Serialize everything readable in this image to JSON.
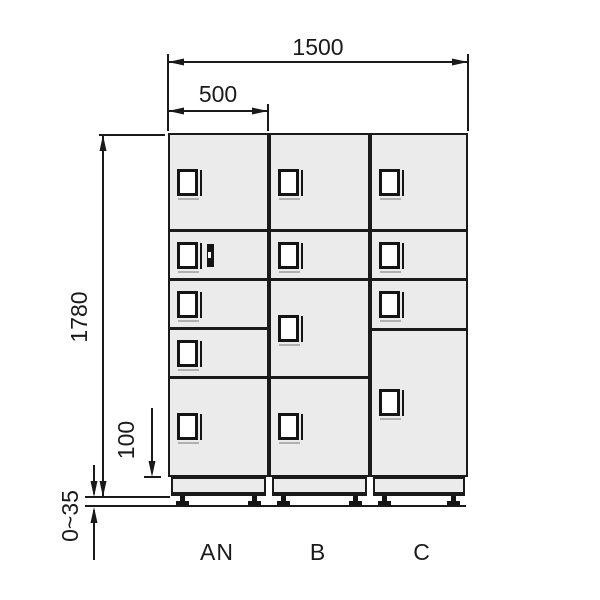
{
  "diagram": {
    "title": "locker-front-elevation",
    "dimension_labels": {
      "total_width": "1500",
      "column_width": "500",
      "total_height": "1780",
      "plinth_height": "100",
      "adjuster_range": "0~35"
    },
    "colors": {
      "line": "#1a1a1a",
      "door_fill": "#ebebeb",
      "handle_fill": "#ffffff",
      "background": "#ffffff"
    },
    "columns": [
      {
        "label": "AN",
        "compartments": [
          {
            "height_px": 97,
            "lock": false
          },
          {
            "height_px": 49,
            "lock": true
          },
          {
            "height_px": 49,
            "lock": false
          },
          {
            "height_px": 49,
            "lock": false
          },
          {
            "height_px": 95,
            "lock": false
          }
        ]
      },
      {
        "label": "B",
        "compartments": [
          {
            "height_px": 97,
            "lock": false
          },
          {
            "height_px": 49,
            "lock": false
          },
          {
            "height_px": 98,
            "lock": false
          },
          {
            "height_px": 95,
            "lock": false
          }
        ]
      },
      {
        "label": "C",
        "compartments": [
          {
            "height_px": 97,
            "lock": false
          },
          {
            "height_px": 49,
            "lock": false
          },
          {
            "height_px": 50,
            "lock": false
          },
          {
            "height_px": 143,
            "lock": false
          }
        ]
      }
    ]
  }
}
